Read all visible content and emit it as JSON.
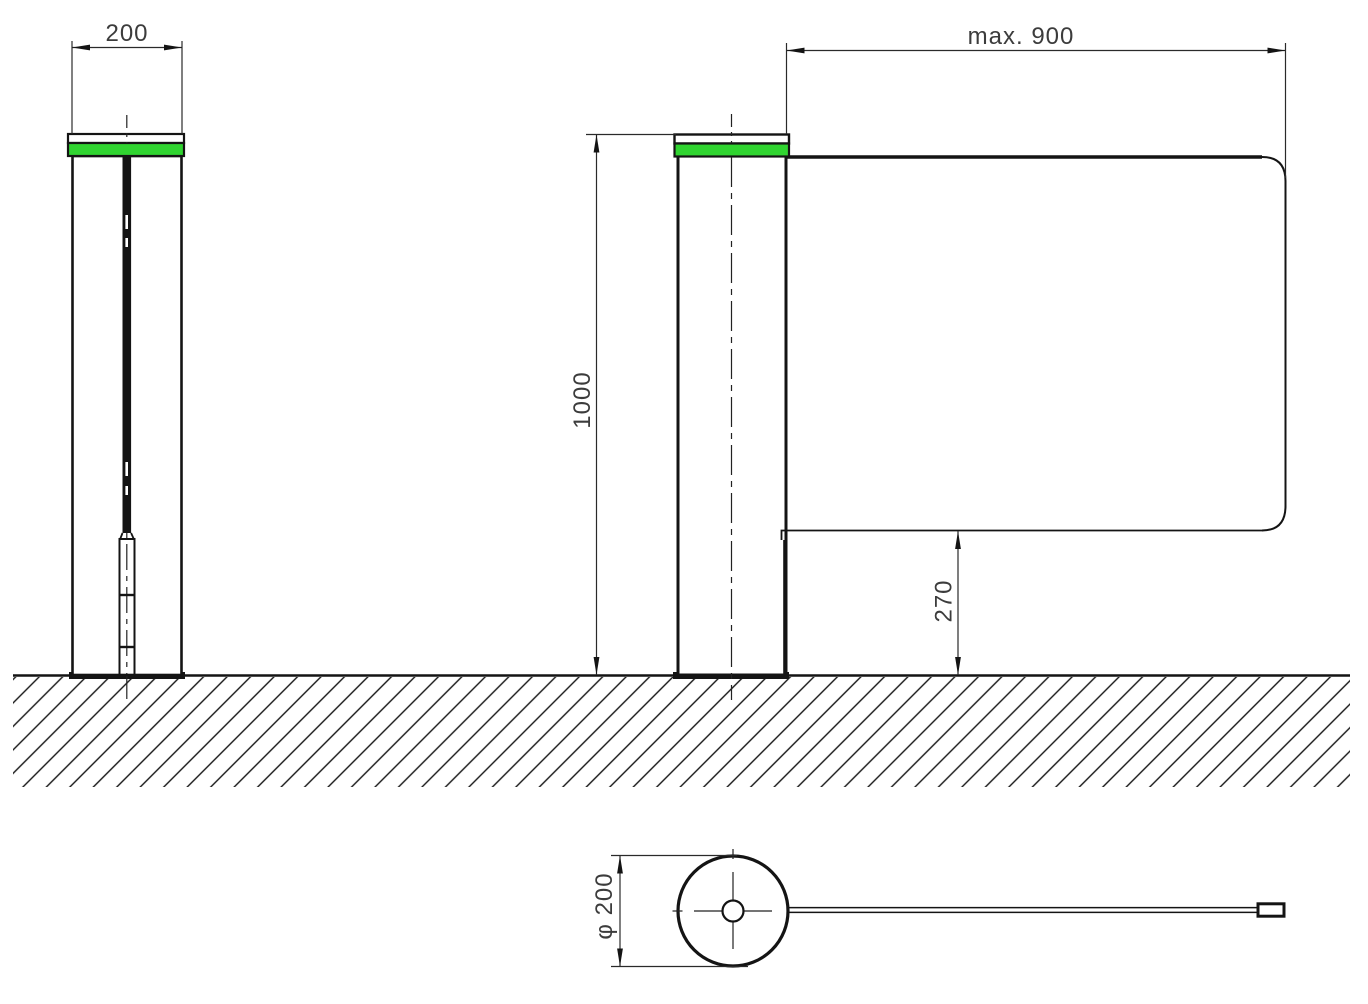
{
  "drawing": {
    "type": "engineering dimension drawing",
    "subject": "Swing gate barrier: side view, front view and plan view with dimensions",
    "views": {
      "side": {
        "label": "side view",
        "post_width_dim": "200"
      },
      "front": {
        "label": "front view",
        "wing_length_dim": "max. 900",
        "post_height_dim": "1000",
        "wing_ground_clearance_dim": "270"
      },
      "plan": {
        "label": "plan view",
        "post_diameter_dim": "φ 200"
      }
    },
    "colors": {
      "line": "#141414",
      "dimension_text": "#3c3c3c",
      "indicator_green": "#30d430",
      "background": "#ffffff"
    }
  }
}
